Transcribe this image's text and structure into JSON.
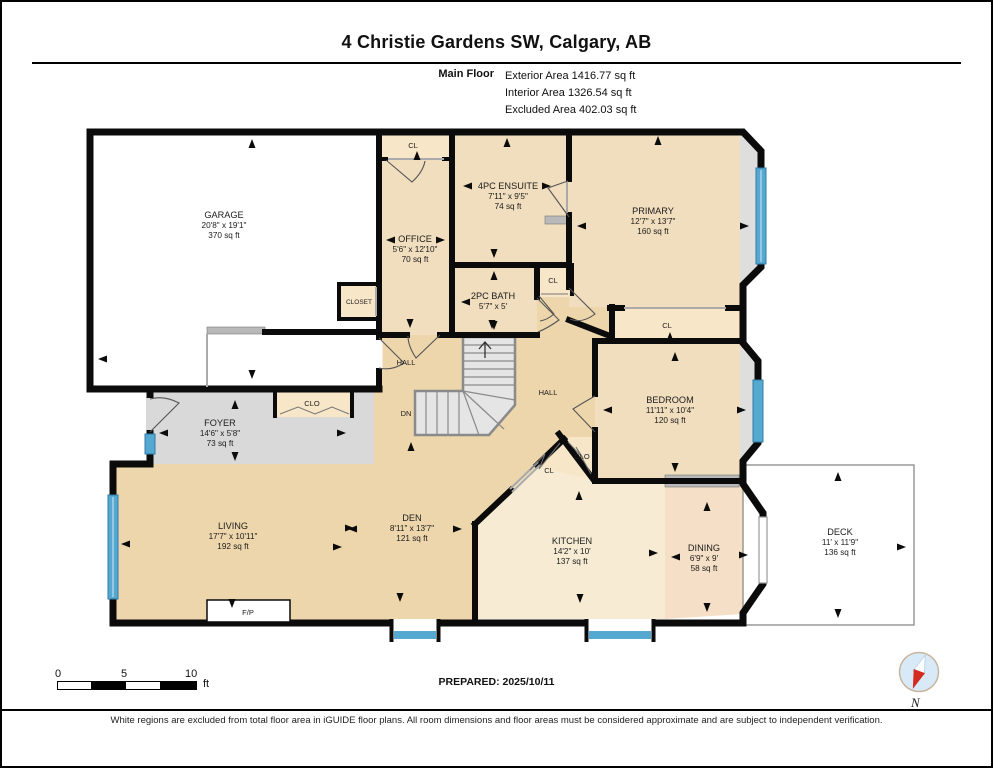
{
  "header": {
    "title": "4 Christie Gardens SW, Calgary, AB",
    "floor": "Main Floor",
    "area_lines": [
      "Exterior Area 1416.77 sq ft",
      "Interior Area 1326.54 sq ft",
      "Excluded Area 402.03 sq ft"
    ]
  },
  "rooms": [
    {
      "name": "GARAGE",
      "dims": "20'8\" x 19'1\"",
      "area": "370 sq ft",
      "x": 222,
      "y": 216
    },
    {
      "name": "OFFICE",
      "dims": "5'6\" x 12'10\"",
      "area": "70 sq ft",
      "x": 413,
      "y": 240
    },
    {
      "name": "4PC ENSUITE",
      "dims": "7'11\" x 9'5\"",
      "area": "74 sq ft",
      "x": 506,
      "y": 187
    },
    {
      "name": "2PC BATH",
      "dims": "5'7\" x 5'",
      "area": "",
      "x": 491,
      "y": 297
    },
    {
      "name": "PRIMARY",
      "dims": "12'7\" x 13'7\"",
      "area": "160 sq ft",
      "x": 651,
      "y": 212
    },
    {
      "name": "BEDROOM",
      "dims": "11'11\" x 10'4\"",
      "area": "120 sq ft",
      "x": 668,
      "y": 401
    },
    {
      "name": "FOYER",
      "dims": "14'6\" x 5'8\"",
      "area": "73 sq ft",
      "x": 218,
      "y": 424
    },
    {
      "name": "LIVING",
      "dims": "17'7\" x 10'11\"",
      "area": "192 sq ft",
      "x": 231,
      "y": 527
    },
    {
      "name": "DEN",
      "dims": "8'11\" x 13'7\"",
      "area": "121 sq ft",
      "x": 410,
      "y": 519
    },
    {
      "name": "KITCHEN",
      "dims": "14'2\" x 10'",
      "area": "137 sq ft",
      "x": 570,
      "y": 542
    },
    {
      "name": "DINING",
      "dims": "6'9\" x 9'",
      "area": "58 sq ft",
      "x": 702,
      "y": 549
    },
    {
      "name": "DECK",
      "dims": "11' x 11'9\"",
      "area": "136 sq ft",
      "x": 838,
      "y": 533
    }
  ],
  "small_labels": [
    {
      "text": "CL",
      "x": 411,
      "y": 146
    },
    {
      "text": "CLOSET",
      "x": 357,
      "y": 302,
      "fs": 6.5
    },
    {
      "text": "CL",
      "x": 551,
      "y": 281
    },
    {
      "text": "CL",
      "x": 665,
      "y": 326
    },
    {
      "text": "CLO",
      "x": 310,
      "y": 404
    },
    {
      "text": "HALL",
      "x": 404,
      "y": 363
    },
    {
      "text": "HALL",
      "x": 546,
      "y": 393
    },
    {
      "text": "DN",
      "x": 404,
      "y": 414
    },
    {
      "text": "CLO",
      "x": 580,
      "y": 457
    },
    {
      "text": "CL",
      "x": 547,
      "y": 471
    },
    {
      "text": "F/P",
      "x": 246,
      "y": 613
    }
  ],
  "footer": {
    "prepared": "PREPARED: 2025/10/11",
    "scale": {
      "zero": "0",
      "five": "5",
      "ten": "10",
      "unit": "ft"
    },
    "compass": "N",
    "disclaimer": "White regions are excluded from total floor area in iGUIDE floor plans. All room dimensions and floor areas must be considered approximate and are subject to independent verification."
  },
  "colors": {
    "wall": "#0b0b0b",
    "hall_tan": "#edd6ab",
    "room_peach": "#f1debe",
    "closet_peach": "#f7e6c8",
    "kitchen": "#f7ecd3",
    "dining": "#f5dfc6",
    "foyer_gray": "#d9d9d9",
    "window_blue": "#55a9d1",
    "compass_red": "#d42b20"
  }
}
